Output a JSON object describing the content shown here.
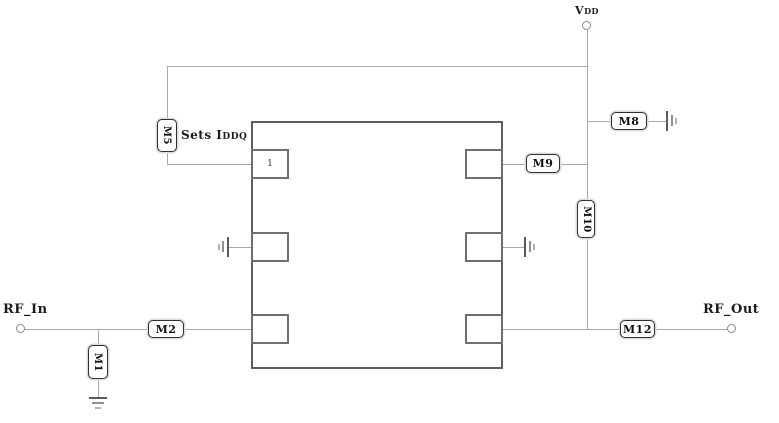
{
  "terminals": {
    "vdd_main": "V",
    "vdd_sub": "DD",
    "rf_in": "RF_In",
    "rf_out": "RF_Out"
  },
  "components": {
    "m1": "M1",
    "m2": "M2",
    "m5": "M5",
    "m8": "M8",
    "m9": "M9",
    "m10": "M10",
    "m12": "M12"
  },
  "annotations": {
    "sets_iddq_main": "Sets I",
    "sets_iddq_sub": "DDQ",
    "pad_number": "1"
  },
  "colors": {
    "wire": "#a8a8a8",
    "block_border": "#5e5e5e",
    "pad_border": "#6f6f6f",
    "component_border": "#2f2f2f",
    "text": "#1c1c1c",
    "background": "#ffffff"
  }
}
